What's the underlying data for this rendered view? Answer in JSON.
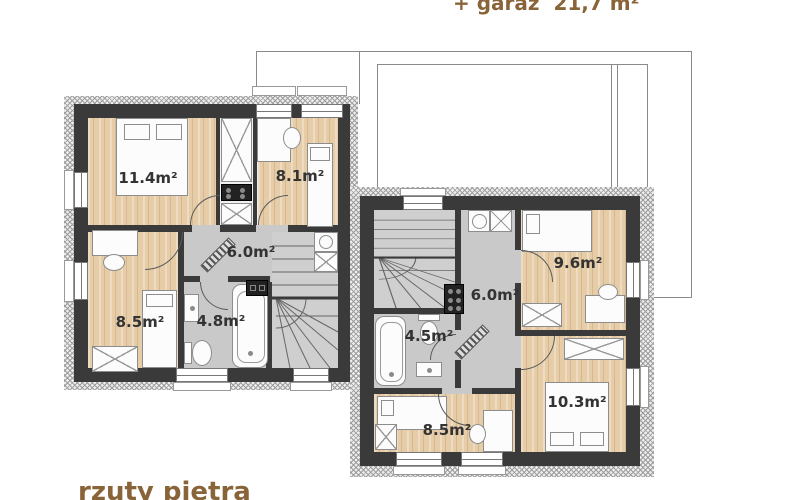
{
  "title_top": "+ garaż  21,7 m²",
  "caption_bottom": "rzuty piętra",
  "colors": {
    "accent_text": "#8a6439",
    "room_label": "#333333",
    "wall": "#3a3a3a",
    "wood_floor": "#e6cda8",
    "gray_floor": "#c9c9c9",
    "outline": "#8a8a8a"
  },
  "plan": {
    "left_unit": {
      "rooms": [
        {
          "name": "bedroom-a",
          "label": "11.4m²"
        },
        {
          "name": "bedroom-b",
          "label": "8.1m²"
        },
        {
          "name": "hall",
          "label": "6.0m²"
        },
        {
          "name": "bedroom-c",
          "label": "8.5m²"
        },
        {
          "name": "bathroom",
          "label": "4.8m²"
        }
      ]
    },
    "right_unit": {
      "rooms": [
        {
          "name": "bedroom-a",
          "label": "9.6m²"
        },
        {
          "name": "hall",
          "label": "6.0m²"
        },
        {
          "name": "bathroom",
          "label": "4.5m²"
        },
        {
          "name": "bedroom-b",
          "label": "8.5m²"
        },
        {
          "name": "bedroom-c",
          "label": "10.3m²"
        }
      ]
    }
  }
}
